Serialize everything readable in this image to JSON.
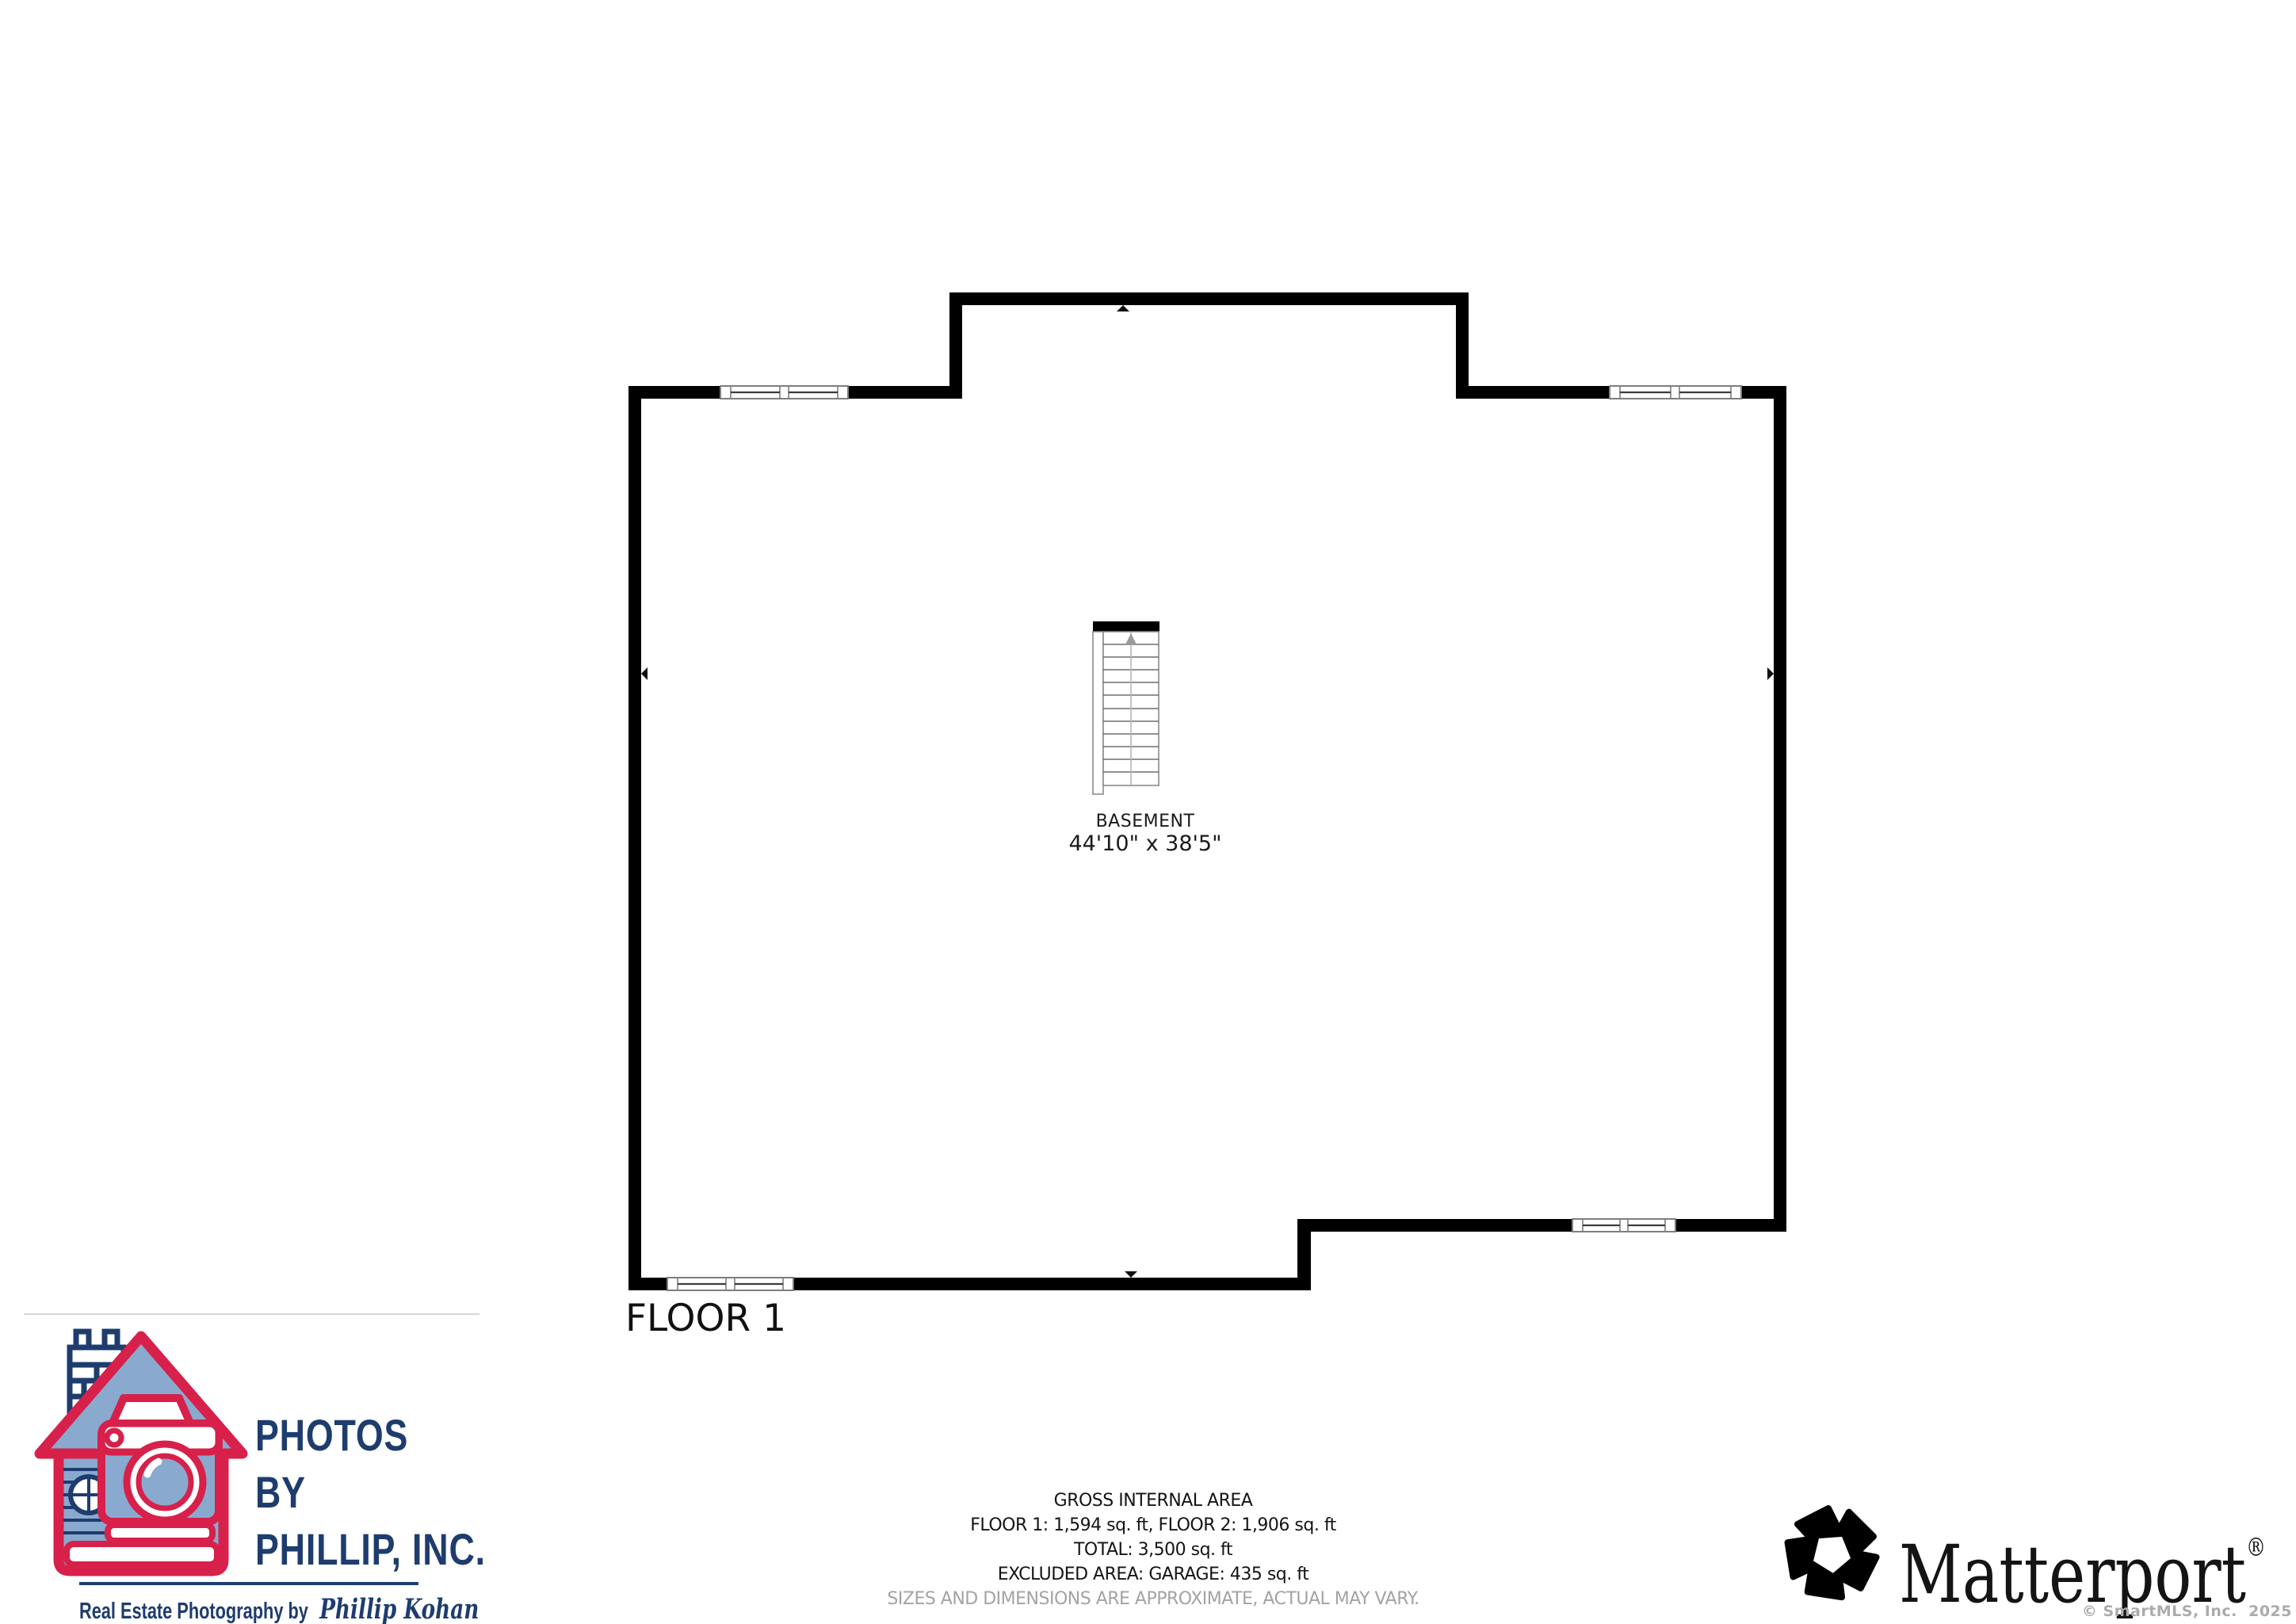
{
  "plan": {
    "room_label": "BASEMENT",
    "room_dimensions": "44'10\" x 38'5\"",
    "floor_label": "FLOOR 1"
  },
  "area_summary": {
    "title": "GROSS INTERNAL AREA",
    "floors": "FLOOR 1: 1,594 sq. ft, FLOOR 2: 1,906 sq. ft",
    "total": "TOTAL: 3,500 sq. ft",
    "excluded": "EXCLUDED AREA: GARAGE: 435 sq. ft",
    "disclaimer": "SIZES AND DIMENSIONS ARE APPROXIMATE, ACTUAL MAY VARY."
  },
  "photographer": {
    "name_line1": "PHOTOS",
    "name_line2": "BY",
    "name_line3": "PHILLIP, INC.",
    "tagline_prefix": "Real Estate Photography by",
    "tagline_name": "Phillip Kohan"
  },
  "matterport": {
    "wordmark": "Matterport",
    "registered_mark": "®"
  },
  "footer": {
    "copyright": "© SmartMLS, Inc.  2025"
  },
  "icons": {
    "stairs_arrow": "stairs-up-arrow",
    "wall_markers": [
      "wall-marker-left",
      "wall-marker-right",
      "wall-marker-top",
      "wall-marker-bottom"
    ],
    "photographer_logo": "house-camera-logo",
    "matterport_logo": "matterport-pentagon-icon"
  },
  "colors": {
    "wall": "#000000",
    "logo_navy": "#1e3c6e",
    "logo_red": "#d7204a",
    "logo_blue": "#8aa9cf",
    "disclaimer_grey": "#a3a3a3",
    "copyright_grey": "#ababab"
  }
}
